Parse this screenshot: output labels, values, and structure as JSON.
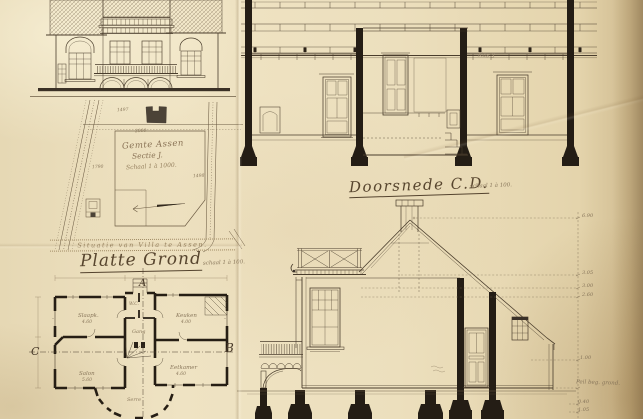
{
  "colors": {
    "paper": "#ebdebc",
    "paper_edge": "#c8b287",
    "ink": "#4a3d2c",
    "ink_faint": "#8a7860",
    "poche_black": "#2b2218"
  },
  "site_plan": {
    "line1": "Gemte Assen",
    "line2": "Sectie J.",
    "line3": "Schaal 1 à 1000.",
    "caption": "Situatie van Villa te Assen.",
    "parcels": [
      "1497",
      "3000",
      "1790",
      "1498"
    ]
  },
  "floor_plan": {
    "title": "Platte Grond",
    "scale_note": "schaal 1 à 100.",
    "marker_top": "A",
    "marker_left": "C",
    "marker_right": "B",
    "rooms": [
      {
        "label": "Slaapk.",
        "dim": "4.60"
      },
      {
        "label": "Keuken",
        "dim": "4.00"
      },
      {
        "label": "Salon",
        "dim": "5.60"
      },
      {
        "label": "Eetkamer",
        "dim": "4.60"
      },
      {
        "label": "Gang",
        "dim": ""
      },
      {
        "label": "Serre",
        "dim": ""
      },
      {
        "label": "W.C.",
        "dim": ""
      }
    ]
  },
  "section_cd": {
    "title": "Doorsnede C.D.",
    "scale_note": "schaal 1 à 100.",
    "pencil_note": "Kas 3"
  },
  "side_section": {
    "levels": [
      {
        "label": "6.90"
      },
      {
        "label": "3.05"
      },
      {
        "label": "3.00"
      },
      {
        "label": "2.60"
      },
      {
        "label": "1.00"
      },
      {
        "label": "Peil beg. grond."
      },
      {
        "label": "0.40"
      },
      {
        "label": "1.05"
      }
    ]
  }
}
